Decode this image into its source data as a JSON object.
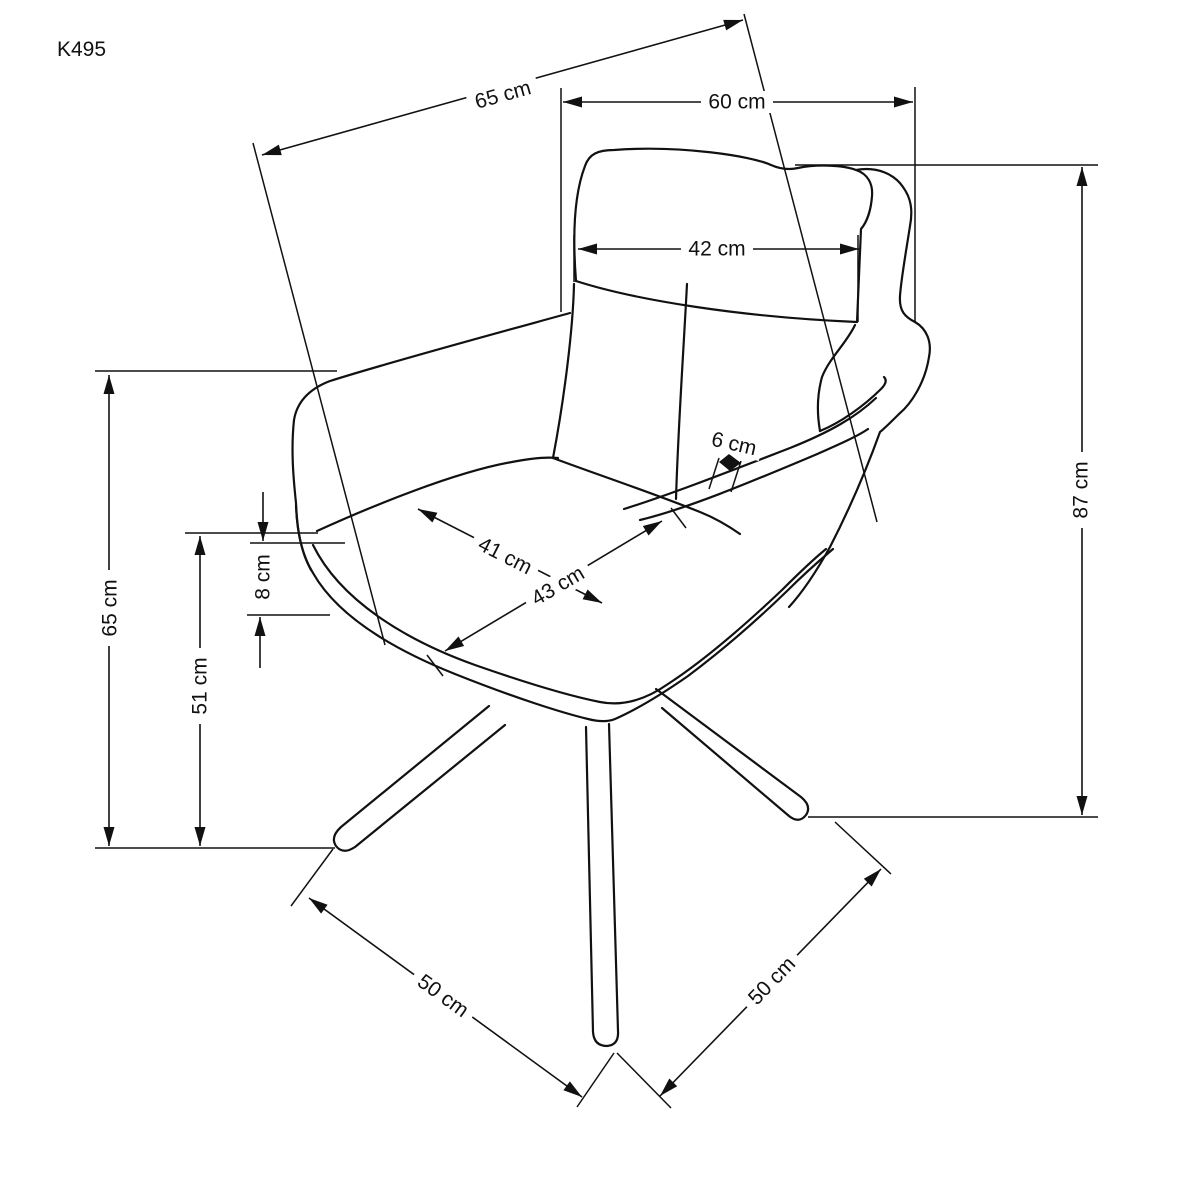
{
  "product_code": "K495",
  "units": "cm",
  "colors": {
    "line": "#111111",
    "background": "#ffffff"
  },
  "diagram": {
    "type": "furniture-dimension-drawing",
    "subject": "upholstered swivel armchair on four splayed legs, three-quarter view",
    "dimensions": [
      {
        "id": "seat-depth-diagonal-top",
        "label": "65 cm",
        "value": 65,
        "unit": "cm",
        "orientation": "diagonal"
      },
      {
        "id": "overall-width",
        "label": "60 cm",
        "value": 60,
        "unit": "cm",
        "orientation": "horizontal"
      },
      {
        "id": "backrest-width",
        "label": "42 cm",
        "value": 42,
        "unit": "cm",
        "orientation": "horizontal"
      },
      {
        "id": "overall-height",
        "label": "87 cm",
        "value": 87,
        "unit": "cm",
        "orientation": "vertical"
      },
      {
        "id": "armrest-height",
        "label": "65 cm",
        "value": 65,
        "unit": "cm",
        "orientation": "vertical"
      },
      {
        "id": "seat-front-thickness",
        "label": "8 cm",
        "value": 8,
        "unit": "cm",
        "orientation": "vertical"
      },
      {
        "id": "seat-height",
        "label": "51 cm",
        "value": 51,
        "unit": "cm",
        "orientation": "vertical"
      },
      {
        "id": "seat-cushion-width",
        "label": "41 cm",
        "value": 41,
        "unit": "cm",
        "orientation": "diagonal"
      },
      {
        "id": "seat-depth",
        "label": "43 cm",
        "value": 43,
        "unit": "cm",
        "orientation": "diagonal"
      },
      {
        "id": "armrest-rim-width",
        "label": "6 cm",
        "value": 6,
        "unit": "cm",
        "orientation": "diagonal"
      },
      {
        "id": "base-width-front",
        "label": "50 cm",
        "value": 50,
        "unit": "cm",
        "orientation": "diagonal"
      },
      {
        "id": "base-depth-side",
        "label": "50 cm",
        "value": 50,
        "unit": "cm",
        "orientation": "diagonal"
      }
    ]
  }
}
